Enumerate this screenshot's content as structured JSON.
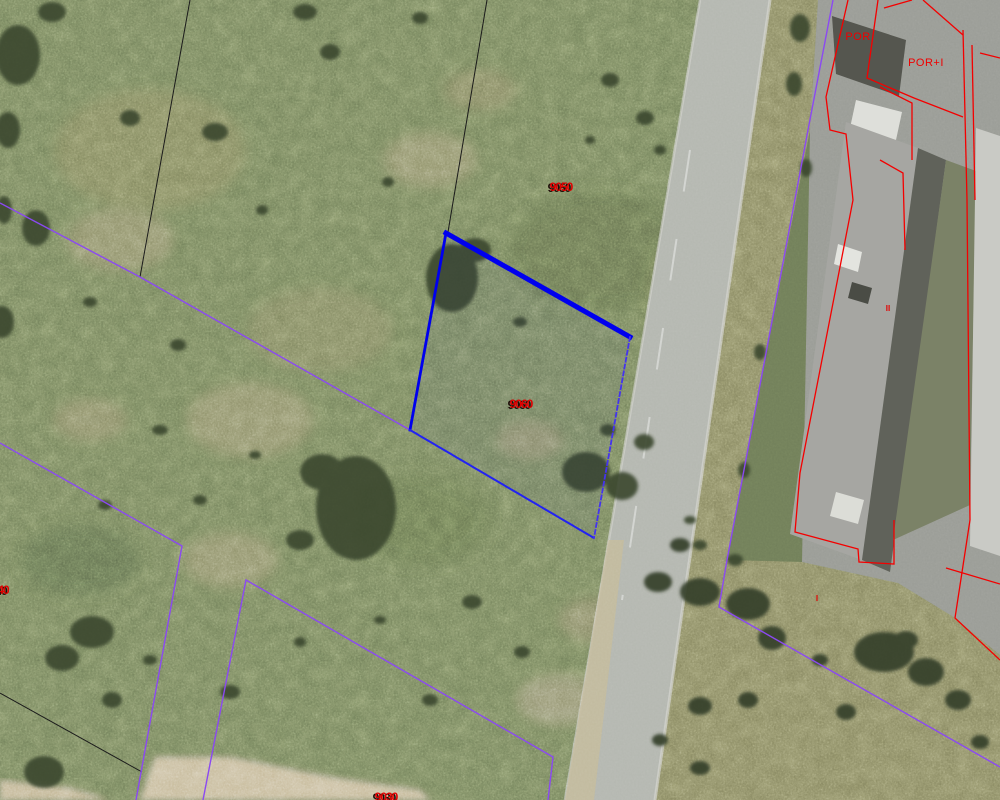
{
  "map": {
    "type": "cadastral-aerial-viewer",
    "colors": {
      "boundary_black": "#1b1b1b",
      "boundary_purple": "#8b49f2",
      "selection_blue": "#0000ee",
      "building_red": "#f40000",
      "label_red": "#e10000"
    }
  },
  "overlay": {
    "black_lines": [
      {
        "name": "boundary-black-north",
        "points": [
          [
            190,
            0
          ],
          [
            140,
            277
          ]
        ]
      },
      {
        "name": "boundary-black-northeast",
        "points": [
          [
            487,
            0
          ],
          [
            448,
            232
          ]
        ]
      },
      {
        "name": "boundary-black-southwest",
        "points": [
          [
            0,
            693
          ],
          [
            142,
            772
          ]
        ]
      }
    ],
    "purple_lines": [
      {
        "name": "boundary-purple-west",
        "points": [
          [
            0,
            203
          ],
          [
            140,
            277
          ],
          [
            410,
            430
          ]
        ]
      },
      {
        "name": "boundary-purple-southwest",
        "points": [
          [
            0,
            443
          ],
          [
            182,
            546
          ],
          [
            136,
            800
          ]
        ]
      },
      {
        "name": "boundary-purple-south",
        "points": [
          [
            203,
            800
          ],
          [
            246,
            580
          ],
          [
            553,
            757
          ],
          [
            548,
            800
          ]
        ]
      },
      {
        "name": "boundary-purple-east",
        "points": [
          [
            833,
            0
          ],
          [
            808,
            130
          ],
          [
            760,
            385
          ],
          [
            727,
            560
          ],
          [
            719,
            607
          ],
          [
            1000,
            767
          ]
        ]
      }
    ],
    "selected_parcel": {
      "name": "selected-parcel-9060",
      "polygon": [
        [
          446,
          233
        ],
        [
          630,
          337
        ],
        [
          594,
          538
        ],
        [
          410,
          430
        ]
      ],
      "edges": [
        {
          "points": [
            [
              446,
              233
            ],
            [
              630,
              337
            ]
          ],
          "width": 5,
          "dash": "",
          "color": "#0000ee"
        },
        {
          "points": [
            [
              446,
              233
            ],
            [
              410,
              430
            ]
          ],
          "width": 2.8,
          "dash": "",
          "color": "#0000ee"
        },
        {
          "points": [
            [
              410,
              430
            ],
            [
              594,
              538
            ]
          ],
          "width": 2,
          "dash": "3 2",
          "color": "#2222f2"
        },
        {
          "points": [
            [
              630,
              337
            ],
            [
              594,
              538
            ]
          ],
          "width": 1.8,
          "dash": "4 3",
          "color": "#4433ee"
        }
      ]
    },
    "red_lines": [
      {
        "name": "building-outline-main",
        "points": [
          [
            848,
            0
          ],
          [
            826,
            97
          ],
          [
            830,
            130
          ],
          [
            846,
            134
          ],
          [
            853,
            200
          ],
          [
            800,
            473
          ],
          [
            795,
            532
          ],
          [
            858,
            549
          ],
          [
            859,
            562
          ],
          [
            894,
            564
          ],
          [
            894,
            520
          ]
        ]
      },
      {
        "name": "building-outline-right",
        "points": [
          [
            963,
            30
          ],
          [
            967,
            200
          ],
          [
            970,
            520
          ],
          [
            955,
            618
          ],
          [
            1000,
            660
          ]
        ]
      },
      {
        "name": "building-outline-right-inner",
        "points": [
          [
            972,
            45
          ],
          [
            975,
            200
          ]
        ]
      },
      {
        "name": "building-porch-diagonal",
        "points": [
          [
            878,
            0
          ],
          [
            867,
            78
          ],
          [
            914,
            98
          ],
          [
            963,
            117
          ]
        ]
      },
      {
        "name": "building-roof-diagonal",
        "points": [
          [
            923,
            0
          ],
          [
            963,
            35
          ]
        ]
      },
      {
        "name": "building-top-edge",
        "points": [
          [
            912,
            0
          ],
          [
            884,
            8
          ]
        ]
      },
      {
        "name": "building-east-stub",
        "points": [
          [
            980,
            53
          ],
          [
            1000,
            58
          ]
        ]
      },
      {
        "name": "building-inner-step-a",
        "points": [
          [
            880,
            87
          ],
          [
            912,
            103
          ],
          [
            912,
            160
          ]
        ]
      },
      {
        "name": "building-inner-step-b",
        "points": [
          [
            880,
            160
          ],
          [
            903,
            173
          ],
          [
            905,
            250
          ]
        ]
      },
      {
        "name": "building-yard-diagonal",
        "points": [
          [
            946,
            568
          ],
          [
            1000,
            584
          ]
        ]
      }
    ],
    "labels": [
      {
        "name": "parcel-number-9050",
        "text": "9050",
        "x": 561,
        "y": 191,
        "cls": "parcel-num",
        "shadow": true,
        "anchor": "middle"
      },
      {
        "name": "parcel-number-9060",
        "text": "9060",
        "x": 521,
        "y": 408,
        "cls": "parcel-num",
        "shadow": true,
        "anchor": "middle"
      },
      {
        "name": "parcel-number-9040",
        "text": "9040",
        "x": -14,
        "y": 594,
        "cls": "parcel-num",
        "shadow": true,
        "anchor": "start"
      },
      {
        "name": "parcel-number-9030",
        "text": "9030",
        "x": 386,
        "y": 801,
        "cls": "parcel-num",
        "shadow": true,
        "anchor": "middle"
      },
      {
        "name": "building-use-por",
        "text": "POR",
        "x": 858,
        "y": 40,
        "cls": "building-label",
        "shadow": false,
        "anchor": "middle"
      },
      {
        "name": "building-use-por-i",
        "text": "POR+I",
        "x": 926,
        "y": 66,
        "cls": "building-label",
        "shadow": false,
        "anchor": "middle"
      },
      {
        "name": "building-floors-ii",
        "text": "II",
        "x": 888,
        "y": 311,
        "cls": "building-label-small",
        "shadow": false,
        "anchor": "middle"
      },
      {
        "name": "building-floors-i",
        "text": "I",
        "x": 817,
        "y": 601,
        "cls": "building-label-small",
        "shadow": false,
        "anchor": "middle"
      }
    ]
  }
}
